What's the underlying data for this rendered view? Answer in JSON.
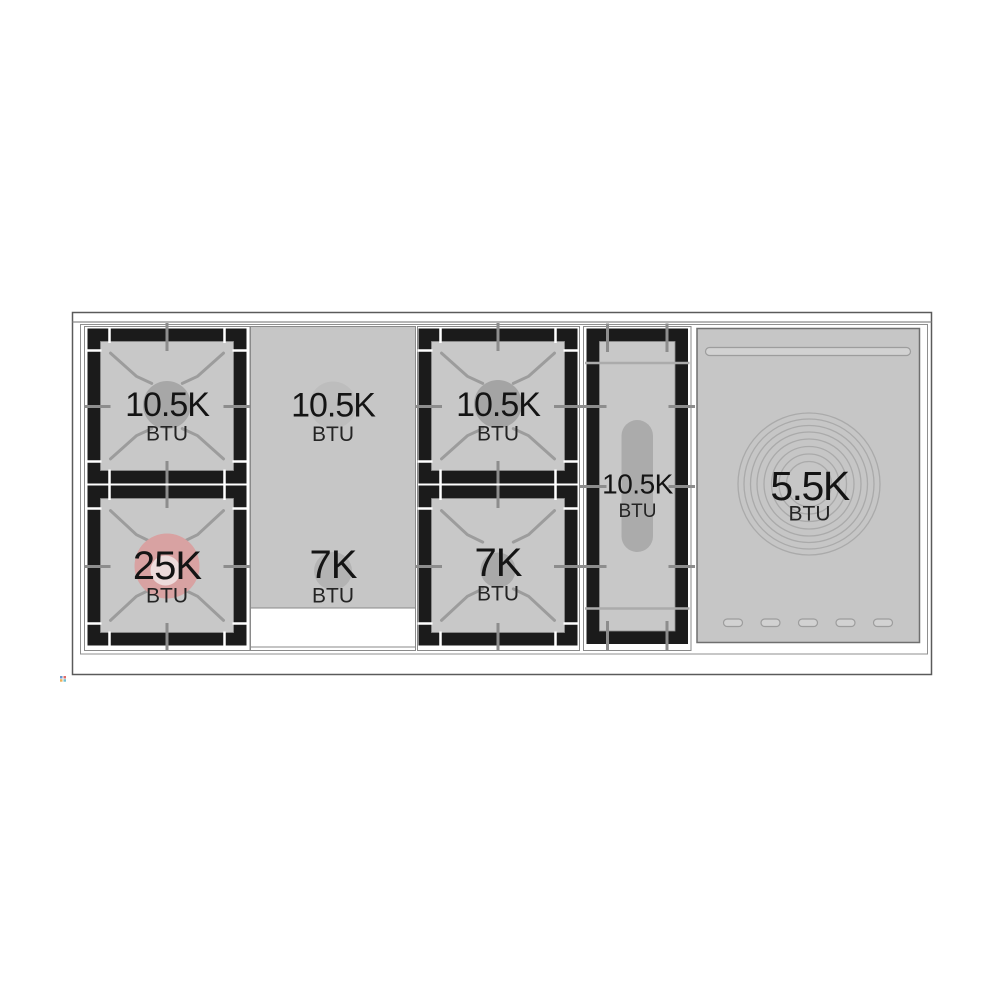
{
  "diagram": {
    "zones": {
      "left_top": {
        "value": "10.5K",
        "unit": "BTU"
      },
      "left_bottom": {
        "value": "25K",
        "unit": "BTU"
      },
      "griddle_top": {
        "value": "10.5K",
        "unit": "BTU"
      },
      "griddle_bottom": {
        "value": "7K",
        "unit": "BTU"
      },
      "center_top": {
        "value": "10.5K",
        "unit": "BTU"
      },
      "center_bottom": {
        "value": "7K",
        "unit": "BTU"
      },
      "oval_burner": {
        "value": "10.5K",
        "unit": "BTU"
      },
      "simmer_plate": {
        "value": "5.5K",
        "unit": "BTU"
      }
    },
    "colors": {
      "accent_pink": "#d8a2a2",
      "accent_pink_light": "#eddcdc",
      "panel_gray": "#c6c6c6",
      "burner_square_gray": "#c8c8c8",
      "grate_black": "#1b1b1b",
      "line_gray": "#9c9c9c",
      "text": "#141414"
    }
  }
}
